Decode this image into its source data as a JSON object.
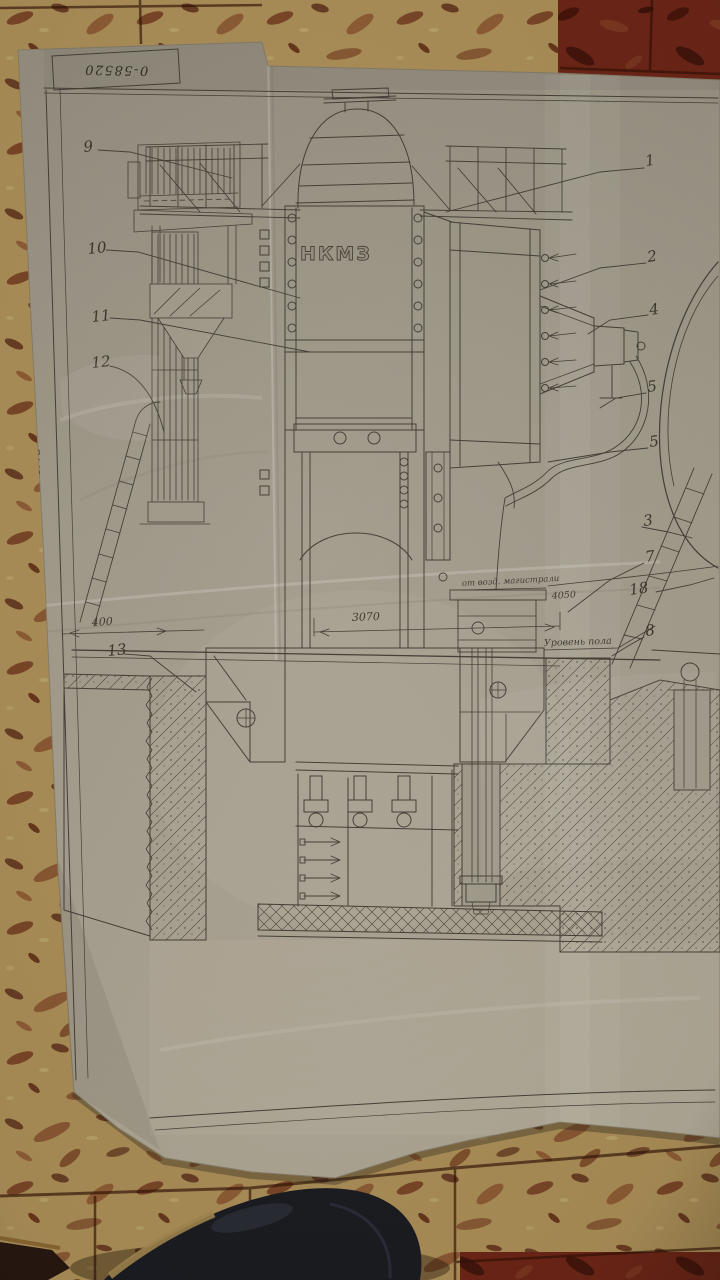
{
  "blueprint": {
    "stamp_number": "0-58520",
    "machine_label": "НКМЗ",
    "margin_note": "4775",
    "pipe_annotation": "от возд. магистрали",
    "pipe_dimension": "4050",
    "floor_level_label": "Уровень пола",
    "dim_center": "3070",
    "dim_left": "400",
    "callouts_left": [
      "9",
      "10",
      "11",
      "12",
      "13"
    ],
    "callouts_right": [
      "1",
      "2",
      "4",
      "5",
      "5",
      "3",
      "7",
      "18",
      "8"
    ]
  },
  "colors": {
    "paper": "#a8a294",
    "ink": "#45413a",
    "cork_base": "#b1945c",
    "cork_dark_tile": "#6e2317",
    "shoe": "#171a22"
  }
}
